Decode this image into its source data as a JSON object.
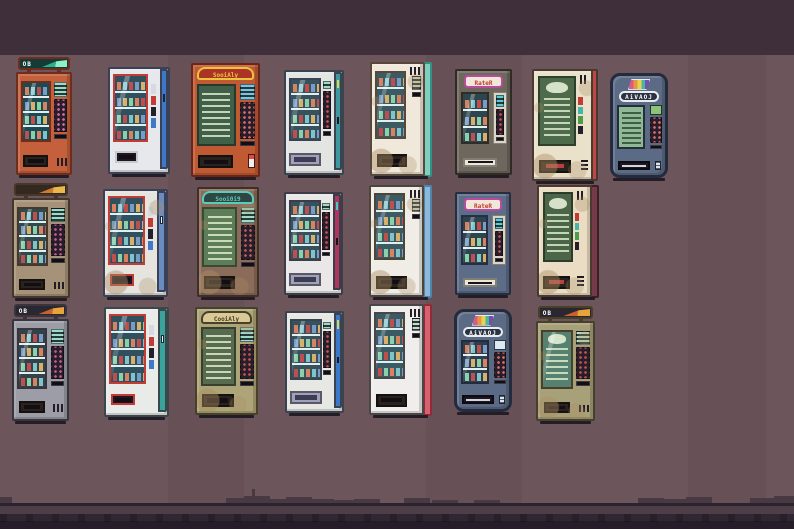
{
  "scene": {
    "type": "pixel-art-sprite-sheet",
    "rows": [
      8,
      7,
      7
    ],
    "machine_count": 22
  },
  "palette": {
    "bg_top_band": "#3e2f3b",
    "bg_main": "#6d565b",
    "skyline": "#483943",
    "shadow_line": "#2b232d",
    "mid_band": "#4e3e48",
    "ground": "#2f2732",
    "ground_dark": "#251e28"
  },
  "machines": [
    {
      "id": "r1c1",
      "row": 1,
      "col": 1,
      "style": "orange-classic-topper",
      "sign_text": "OB",
      "shelves": 4,
      "colors": {
        "body": "#c4613c",
        "edge": "#6f2d1e",
        "glass": "#1c4a54",
        "signbg": "#143b36",
        "keys": "#d86a9a",
        "screenc": "#9fd9c9",
        "swoosh1": "#8ff0c8",
        "swoosh2": "#2fae8b"
      }
    },
    {
      "id": "r1c2",
      "row": 1,
      "col": 2,
      "style": "white-blue-red-frame",
      "shelves": 4,
      "colors": {
        "body": "#e7e8ec",
        "edge": "#3a4156",
        "side": "#3f78c6",
        "frame": "#c23b34",
        "glass": "#30505f"
      }
    },
    {
      "id": "r1c3",
      "row": 1,
      "col": 3,
      "style": "brand-menu-board",
      "sign_text": "SooiAly",
      "shelves": 0,
      "colors": {
        "body": "#c05a33",
        "edge": "#6b2619",
        "signbg": "#ac3326",
        "signfg": "#eac43e",
        "signedge": "#eac43e",
        "menu": "#41604a",
        "keys": "#d86a6a",
        "screenc": "#7ac4e8"
      }
    },
    {
      "id": "r1c4",
      "row": 1,
      "col": 4,
      "style": "white-teal-sidecol",
      "shelves": 4,
      "colors": {
        "body": "#e3e5e3",
        "edge": "#3a4450",
        "side": "#3d98a0",
        "glass": "#36525f",
        "sticker": "#e5d44a",
        "keys": "#c05050"
      }
    },
    {
      "id": "r1c5",
      "row": 1,
      "col": 5,
      "style": "cream-mint-three-quarter",
      "shelves": 4,
      "colors": {
        "body": "#f0e8da",
        "edge": "#57483a",
        "side": "#7fd0c0",
        "edge2": "#2f9486",
        "glass": "#3a5a64",
        "screenc": "#cfd6cc",
        "keys": "#c05050"
      }
    },
    {
      "id": "r1c6",
      "row": 1,
      "col": 6,
      "style": "dark-rater",
      "sign_text": "RateR",
      "shelves": 3,
      "colors": {
        "body": "#6e675d",
        "edge": "#2f2b25",
        "signbg": "#b84aa0",
        "glass": "#2c454e",
        "panel": "#dbd5c5",
        "screenc": "#5cc8d8",
        "keys": "#c05050"
      }
    },
    {
      "id": "r1c7",
      "row": 1,
      "col": 7,
      "style": "cream-red-poster",
      "shelves": 0,
      "colors": {
        "body": "#eae1cb",
        "edge": "#493a31",
        "side": "#bf4747",
        "menu": "#4d6a4a"
      }
    },
    {
      "id": "r1c8",
      "row": 1,
      "col": 8,
      "style": "aivaoj-screen",
      "sign_text": "AiVAOJ",
      "shelves": 0,
      "colors": {
        "body": "#5b6b85",
        "edge": "#232b3c",
        "keys": "#d86a6a",
        "screenc": "#8fb894"
      }
    },
    {
      "id": "r2c1",
      "row": 2,
      "col": 1,
      "style": "tan-classic-topper",
      "shelves": 4,
      "colors": {
        "body": "#a69278",
        "edge": "#46372a",
        "glass": "#2e4a4e",
        "signbg": "#33291f",
        "keys": "#c45a8c",
        "screenc": "#9fd9c9",
        "swoosh1": "#e8b84a",
        "swoosh2": "#d07a32"
      }
    },
    {
      "id": "r2c2",
      "row": 2,
      "col": 2,
      "style": "white-blue-red-frame-worn",
      "shelves": 4,
      "colors": {
        "body": "#e6e4de",
        "edge": "#3a4156",
        "side": "#6b8cbf",
        "frame": "#c23b34",
        "glass": "#30505f"
      }
    },
    {
      "id": "r2c3",
      "row": 2,
      "col": 3,
      "style": "brown-menu-board",
      "sign_text": "Sooi0i9",
      "shelves": 0,
      "colors": {
        "body": "#8b6c5a",
        "edge": "#402e27",
        "signbg": "#2e4743",
        "signfg": "#5accb9",
        "signedge": "#5accb9",
        "menu": "#5d7c58",
        "keys": "#c05a5a",
        "screenc": "#9fd9c9"
      }
    },
    {
      "id": "r2c4",
      "row": 2,
      "col": 4,
      "style": "white-crimson-sidecol",
      "shelves": 4,
      "colors": {
        "body": "#e9e7e7",
        "edge": "#3d3d47",
        "side": "#ae3560",
        "glass": "#36525f",
        "sticker": "#4ac4c4",
        "keys": "#c05050"
      }
    },
    {
      "id": "r2c5",
      "row": 2,
      "col": 5,
      "style": "white-lightblue-three-quarter",
      "shelves": 4,
      "colors": {
        "body": "#f0ede7",
        "edge": "#4d4539",
        "side": "#8fb8d8",
        "edge2": "#4a86ae",
        "glass": "#3a5a64",
        "screenc": "#cfd6cc",
        "keys": "#c05050"
      }
    },
    {
      "id": "r2c6",
      "row": 2,
      "col": 6,
      "style": "slate-rater",
      "sign_text": "RateR",
      "shelves": 3,
      "colors": {
        "body": "#5d6c87",
        "edge": "#262e41",
        "signbg": "#b84aa0",
        "glass": "#2c4350",
        "panel": "#dad4c6",
        "screenc": "#5cc8d8",
        "keys": "#c05050"
      }
    },
    {
      "id": "r2c7",
      "row": 2,
      "col": 7,
      "style": "cream-maroon-poster",
      "shelves": 0,
      "colors": {
        "body": "#eaddc3",
        "edge": "#4b392f",
        "side": "#753b4a",
        "edge2": "#3c2028",
        "menu": "#4a6547"
      }
    },
    {
      "id": "r3c1",
      "row": 3,
      "col": 1,
      "style": "gray-classic-topper",
      "sign_text": "OB",
      "shelves": 4,
      "colors": {
        "body": "#9d9da7",
        "edge": "#38353f",
        "glass": "#32424a",
        "signbg": "#2b2731",
        "keys": "#c45a8c",
        "screenc": "#9fd9c9",
        "swoosh1": "#e8a43a",
        "swoosh2": "#c8622e"
      }
    },
    {
      "id": "r3c2",
      "row": 3,
      "col": 2,
      "style": "white-teal-red-frame",
      "shelves": 4,
      "colors": {
        "body": "#e9ebe9",
        "edge": "#3a474b",
        "side": "#3aa39c",
        "frame": "#c23b34",
        "glass": "#30505f"
      }
    },
    {
      "id": "r3c3",
      "row": 3,
      "col": 3,
      "style": "olive-menu-board",
      "sign_text": "CooiAly",
      "shelves": 0,
      "colors": {
        "body": "#ada577",
        "edge": "#48412a",
        "signbg": "#d8c996",
        "signfg": "#4c3c22",
        "signedge": "#48412a",
        "menu": "#596b4e",
        "keys": "#c05050",
        "screenc": "#9fd9c9"
      }
    },
    {
      "id": "r3c4",
      "row": 3,
      "col": 4,
      "style": "white-blue-sidecol",
      "shelves": 4,
      "colors": {
        "body": "#e7e7e3",
        "edge": "#3a4450",
        "side": "#3a79c9",
        "glass": "#36525f",
        "sticker": "#e5d44a",
        "keys": "#c05050"
      }
    },
    {
      "id": "r3c5",
      "row": 3,
      "col": 5,
      "style": "white-red-three-quarter",
      "shelves": 4,
      "colors": {
        "body": "#f0eeec",
        "edge": "#4a4648",
        "side": "#d9616e",
        "edge2": "#8e2c3c",
        "glass": "#3a5a64",
        "screenc": "#cfd6cc",
        "keys": "#c05050"
      }
    },
    {
      "id": "r3c6",
      "row": 3,
      "col": 6,
      "style": "aivaoj-bottles",
      "sign_text": "AiVAOJ",
      "shelves": 3,
      "colors": {
        "body": "#5b6b85",
        "edge": "#232b3c",
        "glass": "#2c3e52",
        "keys": "#d86a6a",
        "screenc": "#8fb894"
      }
    },
    {
      "id": "r3c7",
      "row": 3,
      "col": 7,
      "style": "olive-poster-topper",
      "sign_text": "OB",
      "shelves": 0,
      "colors": {
        "body": "#a8a078",
        "edge": "#47402b",
        "glass": "#56806f",
        "signbg": "#2b2731",
        "keys": "#c05050",
        "screenc": "#bfe0c8",
        "swoosh1": "#e8a43a",
        "swoosh2": "#c8622e"
      }
    }
  ]
}
